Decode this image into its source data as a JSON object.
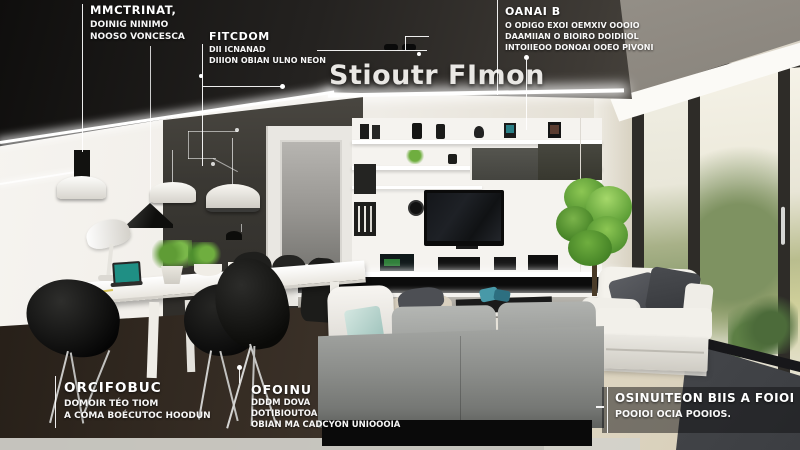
{
  "title": {
    "text": "Stioutr FImon"
  },
  "annotations": {
    "top_left": {
      "heading": "MMCTRINAT,",
      "lines": [
        "DOINIG NINIMO",
        "NOOSO VONCESCA"
      ]
    },
    "top_mid": {
      "heading": "FITCDOM",
      "lines": [
        "DII ICNANAD",
        "DIIION OBIAN ULNO NEON"
      ]
    },
    "top_right": {
      "heading": "OANAI B",
      "lines": [
        "O ODIGO EXOI OEMXIV OOOIO",
        "DAAMIIAN O BIOIRO DOIDIIOL",
        "INTOIIEOO DONOAI OOEO PIVONI"
      ]
    },
    "bottom_left": {
      "heading": "ORCIFOBUC",
      "lines": [
        "DOMOIR TÉO TIOM",
        "A COMA BOÉCUTOC HOODUN"
      ]
    },
    "bottom_mid": {
      "heading": "OFOINU",
      "lines": [
        "DDDM DOVA",
        "DOTIBIOUTOA",
        "OBIAN MA CADCYON UNIOOOIA"
      ]
    },
    "bottom_right": {
      "heading": "OSINUITEON BIIS A FOIOI",
      "lines": [
        "POOIOI OCIA POOIOS."
      ]
    }
  },
  "colors": {
    "ceiling_dark": "#1a1816",
    "accent_wall": "#35332f",
    "wall_white": "#f2efe9",
    "wall_beige": "#d8d2c2",
    "led_white": "#ffffff",
    "window_frame": "#2e2c28",
    "garden_green": "#7e9261",
    "lawn_green": "#c0c488",
    "floor_wood_dark": "#2a2118",
    "floor_beige": "#e8e1d0",
    "floor_slate": "#55575a",
    "sofa_gray": "#909290",
    "pillow_mint": "#bcd9d2",
    "armchair_white": "#f1efe9",
    "pillow_charcoal": "#44464b",
    "tree_green": "#61a432",
    "laptop_screen_teal": "#1f8f84",
    "annotation_text": "#ffffff"
  }
}
